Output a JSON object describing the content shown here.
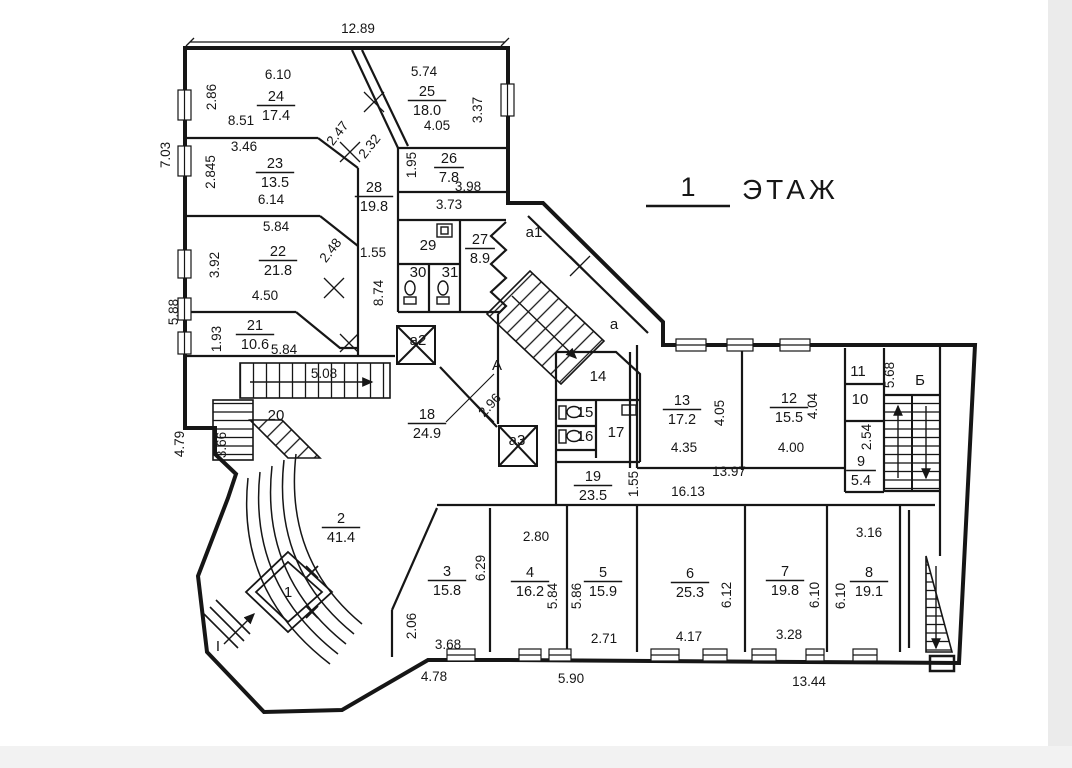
{
  "title": {
    "number": "1",
    "word": "ЭТАЖ"
  },
  "accent_colors": {
    "ink": "#161616",
    "paper": "#ffffff",
    "scan_edge": "#ebebeb"
  },
  "rooms": [
    {
      "n": "24",
      "a": "17.4",
      "x": 276,
      "y": 101
    },
    {
      "n": "23",
      "a": "13.5",
      "x": 275,
      "y": 168
    },
    {
      "n": "25",
      "a": "18.0",
      "x": 427,
      "y": 96
    },
    {
      "n": "26",
      "a": "7.8",
      "x": 449,
      "y": 163
    },
    {
      "n": "28",
      "a": "19.8",
      "x": 374,
      "y": 192
    },
    {
      "n": "27",
      "a": "8.9",
      "x": 480,
      "y": 244
    },
    {
      "n": "22",
      "a": "21.8",
      "x": 278,
      "y": 256
    },
    {
      "n": "21",
      "a": "10.6",
      "x": 255,
      "y": 330
    },
    {
      "n": "18",
      "a": "24.9",
      "x": 427,
      "y": 419
    },
    {
      "n": "19",
      "a": "23.5",
      "x": 593,
      "y": 481
    },
    {
      "n": "13",
      "a": "17.2",
      "x": 682,
      "y": 405
    },
    {
      "n": "12",
      "a": "15.5",
      "x": 789,
      "y": 403
    },
    {
      "n": "9",
      "a": "5.4",
      "x": 861,
      "y": 466
    },
    {
      "n": "2",
      "a": "41.4",
      "x": 341,
      "y": 523
    },
    {
      "n": "3",
      "a": "15.8",
      "x": 447,
      "y": 576
    },
    {
      "n": "4",
      "a": "16.2",
      "x": 530,
      "y": 577
    },
    {
      "n": "5",
      "a": "15.9",
      "x": 603,
      "y": 577
    },
    {
      "n": "6",
      "a": "25.3",
      "x": 690,
      "y": 578
    },
    {
      "n": "7",
      "a": "19.8",
      "x": 785,
      "y": 576
    },
    {
      "n": "8",
      "a": "19.1",
      "x": 869,
      "y": 577
    }
  ],
  "zone_labels": [
    {
      "t": "20",
      "x": 276,
      "y": 420,
      "s": 15
    },
    {
      "t": "29",
      "x": 428,
      "y": 250,
      "s": 14
    },
    {
      "t": "30",
      "x": 418,
      "y": 277,
      "s": 13
    },
    {
      "t": "31",
      "x": 450,
      "y": 277,
      "s": 13
    },
    {
      "t": "14",
      "x": 598,
      "y": 381,
      "s": 14
    },
    {
      "t": "15",
      "x": 585,
      "y": 417,
      "s": 13
    },
    {
      "t": "16",
      "x": 585,
      "y": 441,
      "s": 13
    },
    {
      "t": "17",
      "x": 616,
      "y": 437,
      "s": 14
    },
    {
      "t": "11",
      "x": 858,
      "y": 376,
      "s": 13
    },
    {
      "t": "10",
      "x": 860,
      "y": 404,
      "s": 14
    },
    {
      "t": "1",
      "x": 288,
      "y": 597,
      "s": 14
    },
    {
      "t": "А",
      "x": 497,
      "y": 370,
      "s": 17
    },
    {
      "t": "а",
      "x": 614,
      "y": 329,
      "s": 16
    },
    {
      "t": "а1",
      "x": 534,
      "y": 237,
      "s": 15
    },
    {
      "t": "а2",
      "x": 418,
      "y": 345,
      "s": 15
    },
    {
      "t": "а3",
      "x": 517,
      "y": 445,
      "s": 15
    },
    {
      "t": "Б",
      "x": 920,
      "y": 385,
      "s": 17
    },
    {
      "t": "I",
      "x": 218,
      "y": 651,
      "s": 15
    }
  ],
  "dimensions": [
    {
      "t": "12.89",
      "x": 358,
      "y": 33,
      "r": 0
    },
    {
      "t": "7.03",
      "x": 170,
      "y": 155,
      "r": -90
    },
    {
      "t": "5.88",
      "x": 178,
      "y": 312,
      "r": -90
    },
    {
      "t": "4.79",
      "x": 184,
      "y": 444,
      "r": -90
    },
    {
      "t": "2.86",
      "x": 216,
      "y": 97,
      "r": -90
    },
    {
      "t": "8.51",
      "x": 241,
      "y": 125,
      "r": 0
    },
    {
      "t": "6.10",
      "x": 278,
      "y": 79,
      "r": 0
    },
    {
      "t": "3.46",
      "x": 244,
      "y": 151,
      "r": 0
    },
    {
      "t": "2.845",
      "x": 215,
      "y": 172,
      "r": -90
    },
    {
      "t": "6.14",
      "x": 271,
      "y": 204,
      "r": 0
    },
    {
      "t": "3.92",
      "x": 219,
      "y": 265,
      "r": -90
    },
    {
      "t": "5.84",
      "x": 276,
      "y": 231,
      "r": 0
    },
    {
      "t": "4.50",
      "x": 265,
      "y": 300,
      "r": 0
    },
    {
      "t": "1.93",
      "x": 221,
      "y": 339,
      "r": -90
    },
    {
      "t": "5.84",
      "x": 284,
      "y": 354,
      "r": 0
    },
    {
      "t": "5.08",
      "x": 324,
      "y": 378,
      "r": 0
    },
    {
      "t": "3.66",
      "x": 226,
      "y": 445,
      "r": -90
    },
    {
      "t": "2.47",
      "x": 341,
      "y": 136,
      "r": -52
    },
    {
      "t": "2.32",
      "x": 373,
      "y": 149,
      "r": -52
    },
    {
      "t": "2.48",
      "x": 334,
      "y": 253,
      "r": -52
    },
    {
      "t": "5.74",
      "x": 424,
      "y": 76,
      "r": 0
    },
    {
      "t": "3.37",
      "x": 482,
      "y": 110,
      "r": -90
    },
    {
      "t": "4.05",
      "x": 437,
      "y": 130,
      "r": 0
    },
    {
      "t": "1.95",
      "x": 416,
      "y": 165,
      "r": -90
    },
    {
      "t": "3.98",
      "x": 468,
      "y": 191,
      "r": 0
    },
    {
      "t": "3.73",
      "x": 449,
      "y": 209,
      "r": 0
    },
    {
      "t": "1.55",
      "x": 373,
      "y": 257,
      "r": 0
    },
    {
      "t": "8.74",
      "x": 383,
      "y": 293,
      "r": -90
    },
    {
      "t": "2.96",
      "x": 493,
      "y": 408,
      "r": -48
    },
    {
      "t": "4.05",
      "x": 724,
      "y": 413,
      "r": -90
    },
    {
      "t": "4.35",
      "x": 684,
      "y": 452,
      "r": 0
    },
    {
      "t": "4.04",
      "x": 817,
      "y": 406,
      "r": -90
    },
    {
      "t": "4.00",
      "x": 791,
      "y": 452,
      "r": 0
    },
    {
      "t": "5.68",
      "x": 894,
      "y": 375,
      "r": -90
    },
    {
      "t": "2.54",
      "x": 871,
      "y": 437,
      "r": -90
    },
    {
      "t": "13.97",
      "x": 729,
      "y": 476,
      "r": 0
    },
    {
      "t": "16.13",
      "x": 688,
      "y": 496,
      "r": 0
    },
    {
      "t": "1.55",
      "x": 638,
      "y": 484,
      "r": -90
    },
    {
      "t": "2.80",
      "x": 536,
      "y": 541,
      "r": 0
    },
    {
      "t": "5.84",
      "x": 557,
      "y": 596,
      "r": -90
    },
    {
      "t": "5.86",
      "x": 581,
      "y": 596,
      "r": -90
    },
    {
      "t": "2.71",
      "x": 604,
      "y": 643,
      "r": 0
    },
    {
      "t": "6.29",
      "x": 485,
      "y": 568,
      "r": -90
    },
    {
      "t": "2.06",
      "x": 416,
      "y": 626,
      "r": -90
    },
    {
      "t": "3.68",
      "x": 448,
      "y": 649,
      "r": 0
    },
    {
      "t": "4.78",
      "x": 434,
      "y": 681,
      "r": 0
    },
    {
      "t": "5.90",
      "x": 571,
      "y": 683,
      "r": 0
    },
    {
      "t": "6.12",
      "x": 731,
      "y": 595,
      "r": -90
    },
    {
      "t": "4.17",
      "x": 689,
      "y": 641,
      "r": 0
    },
    {
      "t": "3.28",
      "x": 789,
      "y": 639,
      "r": 0
    },
    {
      "t": "6.10",
      "x": 819,
      "y": 595,
      "r": -90
    },
    {
      "t": "6.10",
      "x": 845,
      "y": 596,
      "r": -90
    },
    {
      "t": "3.16",
      "x": 869,
      "y": 537,
      "r": 0
    },
    {
      "t": "13.44",
      "x": 809,
      "y": 686,
      "r": 0
    }
  ]
}
